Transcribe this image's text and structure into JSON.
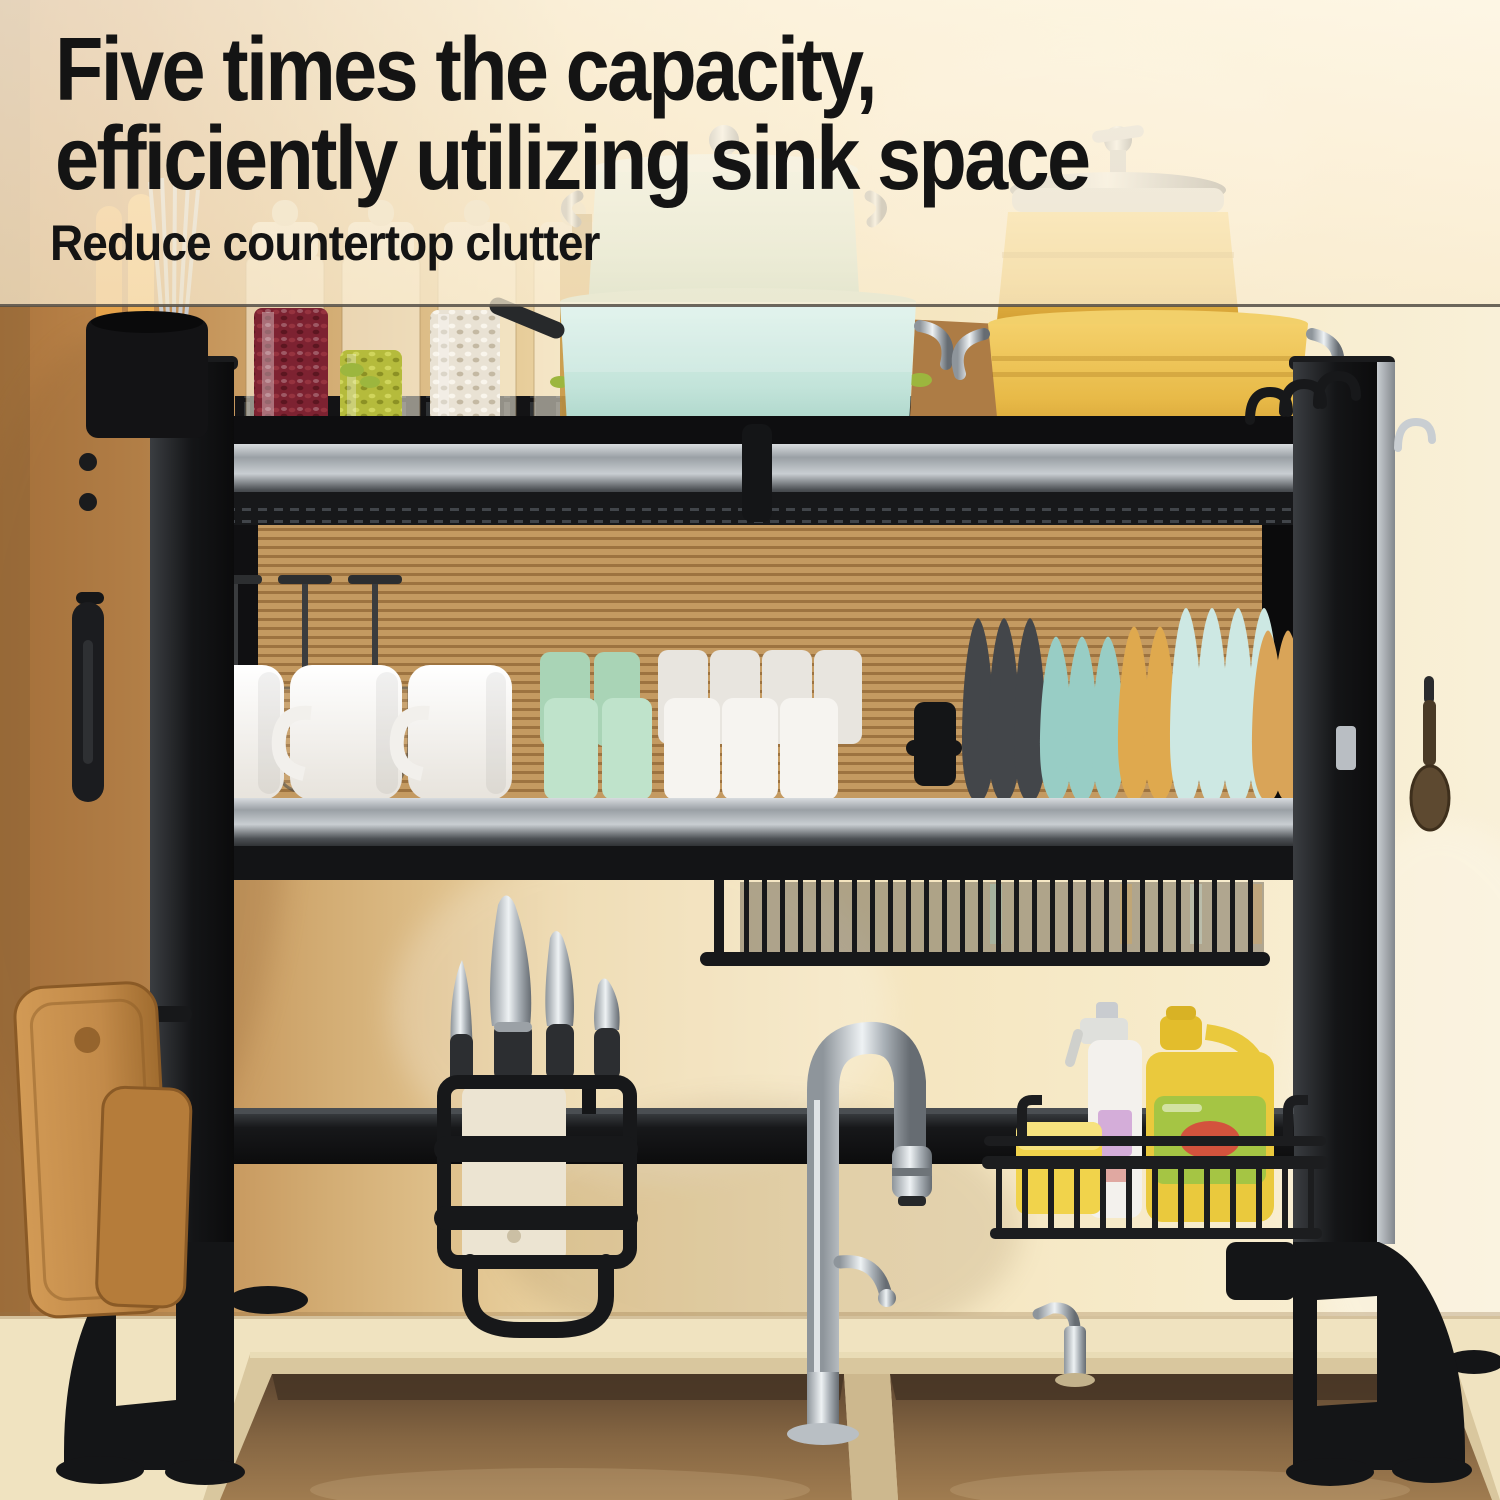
{
  "banner": {
    "headline_line1": "Five times the capacity,",
    "headline_line2": "efficiently utilizing sink space",
    "subheadline": "Reduce countertop clutter"
  },
  "palette": {
    "headline": "#141414",
    "shadow_line": "#534d45",
    "overlay_cream": "#fcf0d8",
    "wall_left": "#b97f45",
    "wall_right": "#f8eecd",
    "blind_light": "#c49a61",
    "blind_dark": "#9d7340",
    "rack_black": "#141517",
    "metal_light": "#c9ced2",
    "metal_dark": "#3c4044",
    "pot_teal": "#cdeae1",
    "pot_yellow": "#eec155",
    "jar_red": "#7d2231",
    "jar_olive": "#b5bb3c",
    "jar_white": "#e9e2d4",
    "lid_ivory": "#e9ddc4",
    "oil_amber": "#c08a2e",
    "box_brown": "#b08049",
    "mug_white": "#f6f4f0",
    "cup_mint": "#bfe3cb",
    "plate_dark": "#43464a",
    "plate_teal": "#98cdc5",
    "plate_yellow": "#dfa94e",
    "plate_mint": "#cde8e3",
    "plate_amber": "#d9a458",
    "wood": "#c28a49",
    "knife_steel": "#cdd0d3",
    "knife_handle": "#2c2e31",
    "chrome": "#d9dde1",
    "counter": "#f0e3c0",
    "sink_rim": "#d9c79e",
    "sink_bowl": "#77593c",
    "soap_yellow": "#eac93d",
    "soap_green": "#a5c544",
    "soap_red": "#d8463d",
    "spray_white": "#f3f1ed",
    "sponge": "#f1d34b",
    "basket": "#1c1d1f"
  }
}
